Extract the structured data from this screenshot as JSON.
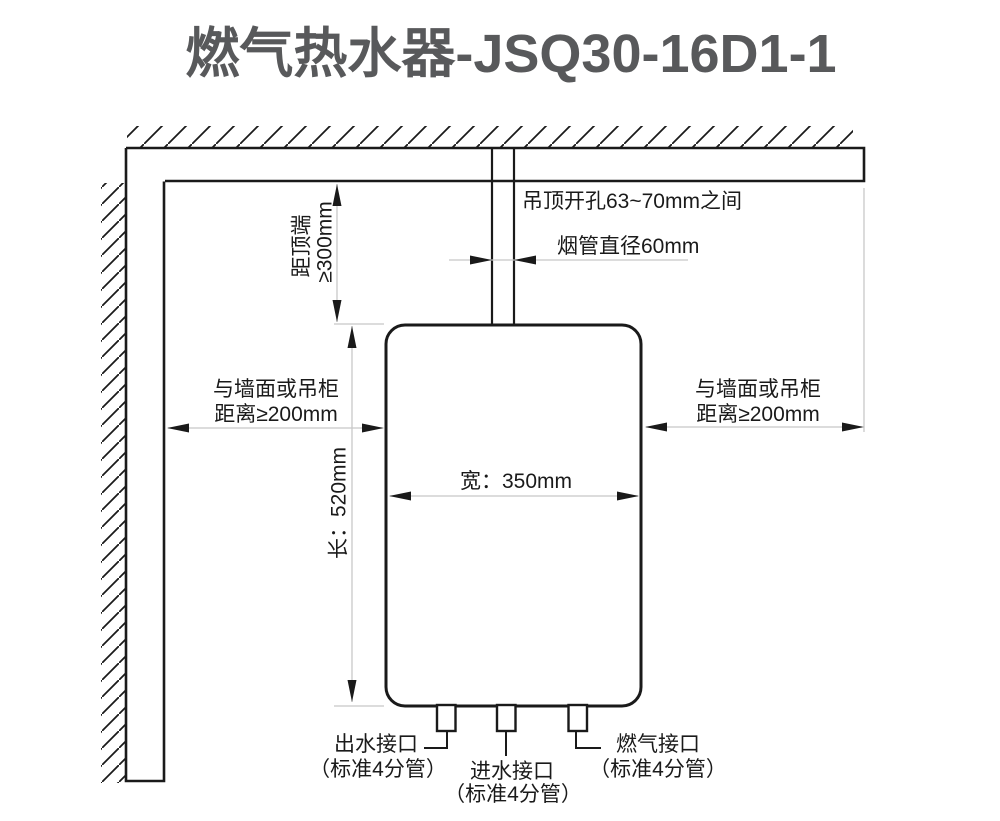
{
  "title": "燃气热水器-JSQ30-16D1-1",
  "colors": {
    "title": "#58595b",
    "line": "#1a1a1a",
    "dim_line": "#c8c8c8",
    "background": "#ffffff"
  },
  "labels": {
    "top_clearance_1": "距顶端",
    "top_clearance_2": "≥300mm",
    "ceiling_hole": "吊顶开孔63~70mm之间",
    "flue_diameter": "烟管直径60mm",
    "left_clearance_1": "与墙面或吊柜",
    "left_clearance_2": "距离≥200mm",
    "right_clearance_1": "与墙面或吊柜",
    "right_clearance_2": "距离≥200mm",
    "height": "长：520mm",
    "width": "宽：350mm",
    "outlet_1": "出水接口",
    "outlet_2": "（标准4分管）",
    "inlet_1": "进水接口",
    "inlet_2": "（标准4分管）",
    "gas_1": "燃气接口",
    "gas_2": "（标准4分管）"
  }
}
